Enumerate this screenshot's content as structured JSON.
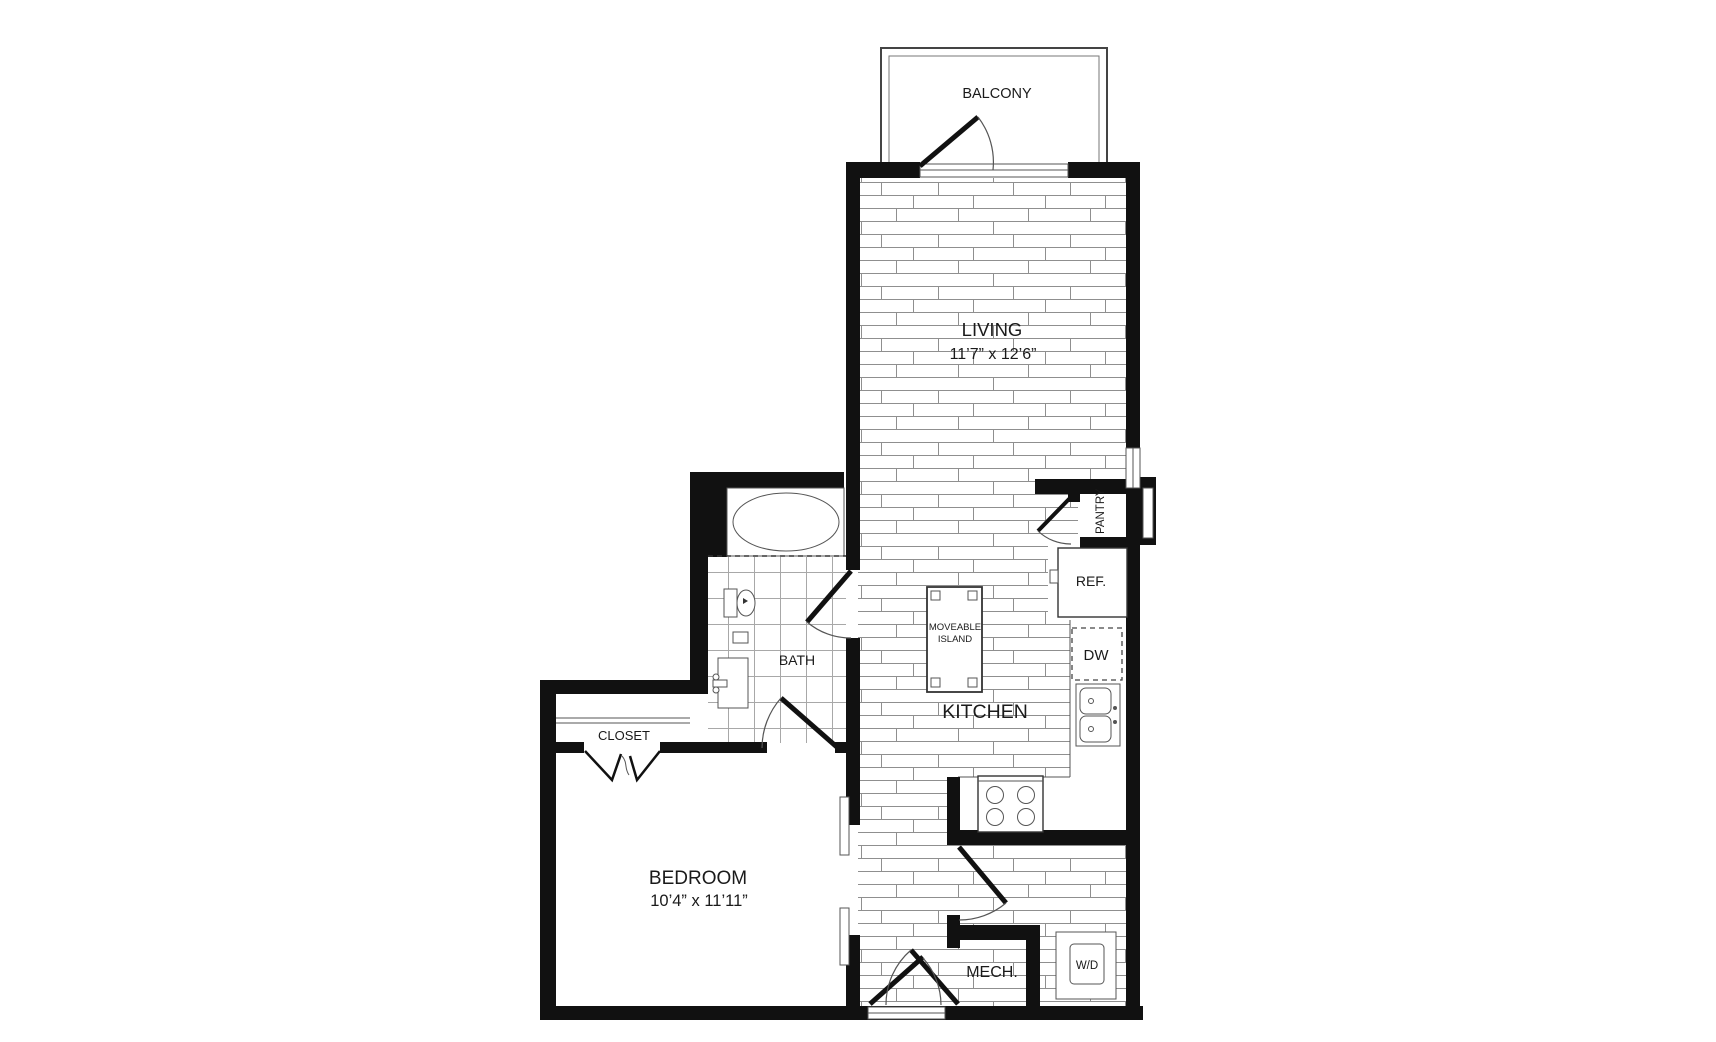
{
  "plan": {
    "type": "apartment-floor-plan",
    "colors": {
      "wall": "#111111",
      "floor_lines": "#8f8f8f",
      "tile_lines": "#a8a8a8",
      "text": "#1a1a1a",
      "background": "#ffffff"
    },
    "rooms": {
      "balcony": {
        "label": "BALCONY"
      },
      "living": {
        "label": "LIVING",
        "dimensions": "11’7” x 12’6”"
      },
      "kitchen": {
        "label": "KITCHEN"
      },
      "bedroom": {
        "label": "BEDROOM",
        "dimensions": "10’4” x 11’11”"
      },
      "closet": {
        "label": "CLOSET"
      },
      "bath": {
        "label": "BATH"
      },
      "mech": {
        "label": "MECH."
      },
      "pantry": {
        "label": "PANTRY"
      }
    },
    "fixtures": {
      "refrigerator": {
        "label": "REF."
      },
      "dishwasher": {
        "label": "DW"
      },
      "washer_dryer": {
        "label": "W/D"
      },
      "island": {
        "line1": "MOVEABLE",
        "line2": "ISLAND"
      }
    }
  }
}
